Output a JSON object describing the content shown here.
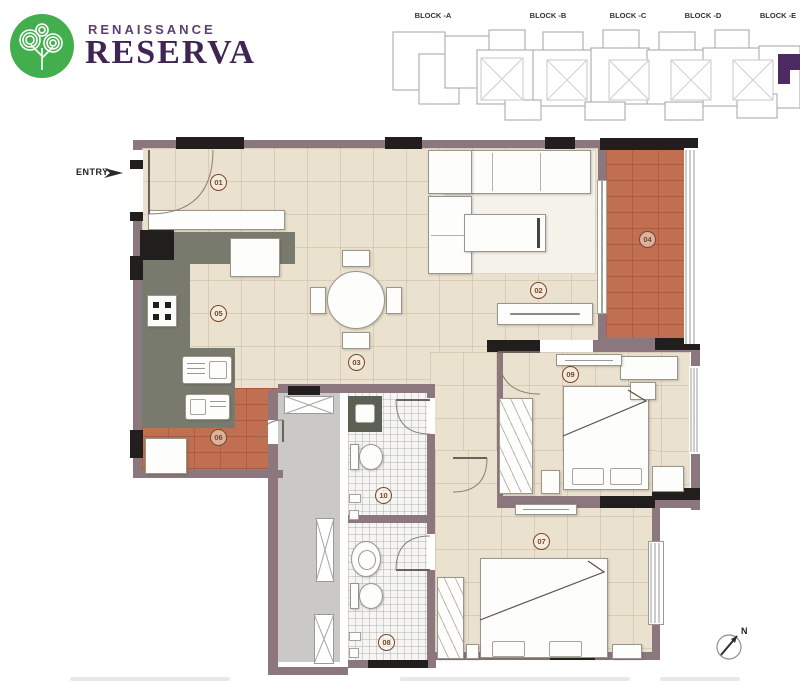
{
  "brand": {
    "line1": "RENAISSANCE",
    "line2": "RESERVA"
  },
  "key_plan": {
    "block_labels": [
      "BLOCK -A",
      "BLOCK -B",
      "BLOCK -C",
      "BLOCK -D",
      "BLOCK -E"
    ],
    "highlight_color": "#4e2a63"
  },
  "floor_plan": {
    "entry_label": "ENTRY",
    "compass_label": "N",
    "rooms": [
      "01",
      "02",
      "03",
      "04",
      "05",
      "06",
      "07",
      "08",
      "09",
      "10"
    ]
  },
  "colors": {
    "brand_green": "#42ae4e",
    "brand_purple": "#3f2454",
    "wall": "#8b777d",
    "column": "#211e1d",
    "floor": "#eae1cf",
    "balcony_floor": "#c06f50",
    "kitchen_counter": "#787a6d",
    "room_label": "#7c4527"
  }
}
